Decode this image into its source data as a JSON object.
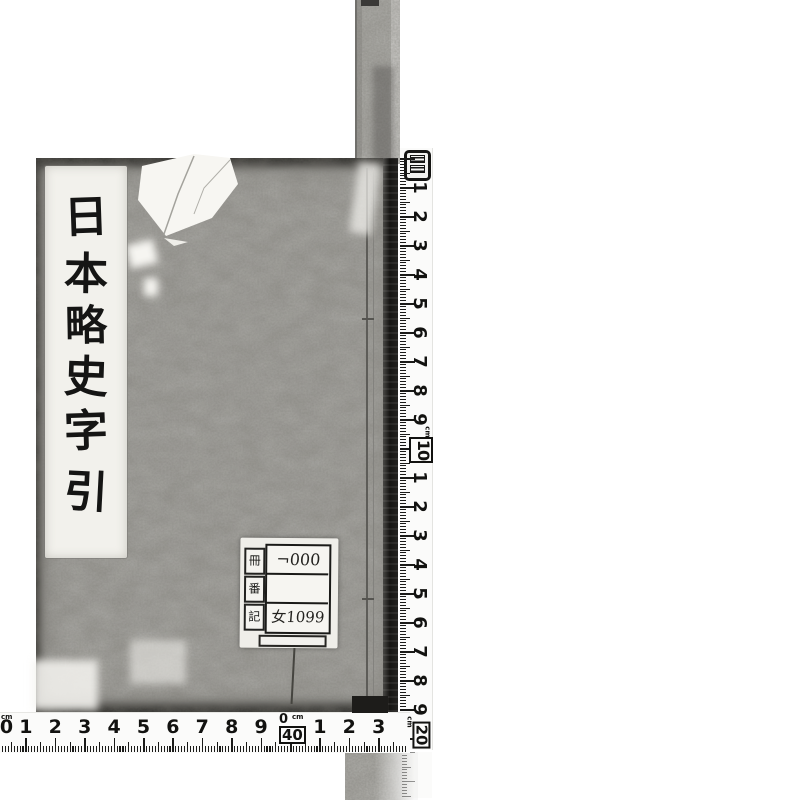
{
  "scan": {
    "kind": "digitized book cover scan",
    "book": {
      "title": "日本略史字引",
      "title_chars": [
        "日",
        "本",
        "略",
        "史",
        "字",
        "引"
      ]
    },
    "label": {
      "field_names": [
        "冊",
        "番",
        "記"
      ],
      "rows": [
        "¬000",
        "",
        "女1099"
      ]
    },
    "vertical_ruler": {
      "unit": "cm",
      "numbers": [
        "1",
        "2",
        "3",
        "4",
        "5",
        "6",
        "7",
        "8",
        "9",
        "10",
        "1",
        "2",
        "3",
        "4",
        "5",
        "6",
        "7",
        "8",
        "9"
      ],
      "corner_number": "20"
    },
    "horizontal_ruler": {
      "unit": "cm",
      "start_number": "0",
      "numbers": [
        "1",
        "2",
        "3",
        "4",
        "5",
        "6",
        "7",
        "8",
        "9"
      ],
      "mid_small": "0",
      "mid_big": "40",
      "after_numbers": [
        "1",
        "2",
        "3"
      ]
    },
    "colors": {
      "cover": "#a9a8a4",
      "spine": "#1a1918",
      "slip": "#f2f1ec",
      "ink": "#151514",
      "ruler_bg": "#fbfbfa"
    }
  }
}
